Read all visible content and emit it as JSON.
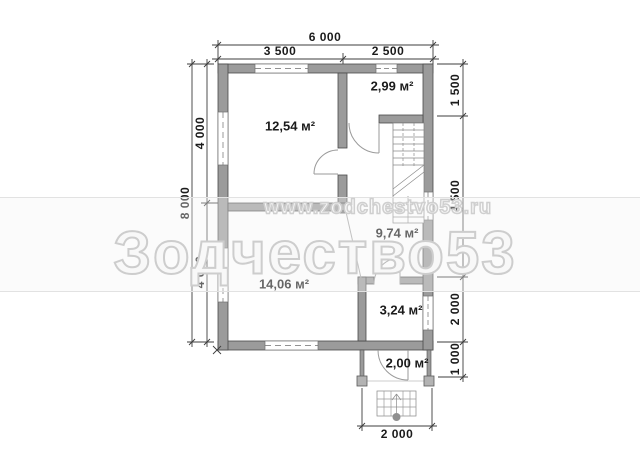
{
  "plan": {
    "rooms": [
      {
        "id": "living-room",
        "area": "12,54 м²"
      },
      {
        "id": "entry-room",
        "area": "2,99 м²"
      },
      {
        "id": "hall-stairs",
        "area": "9,74 м²"
      },
      {
        "id": "main-room",
        "area": "14,06 м²"
      },
      {
        "id": "wc",
        "area": "3,24 м²"
      },
      {
        "id": "porch",
        "area": "2,00 м²"
      }
    ]
  },
  "dimensions": {
    "top": {
      "overall": "6 000",
      "left_span": "3 500",
      "right_span": "2 500"
    },
    "left": {
      "overall": "8 000",
      "upper_span": "4 000",
      "lower_span": "4 000"
    },
    "right": {
      "span1": "1 500",
      "span2": "4 500",
      "span3": "2 000",
      "span4": "1 000"
    },
    "bottom": {
      "porch_span": "2 000"
    }
  },
  "watermark": {
    "url_text": "www.zodchestvo53.ru",
    "brand_text": "Зодчество53"
  },
  "colors": {
    "wall_fill": "#9b9b9b",
    "wall_outline": "#4a4a4a",
    "dimension_line": "#3c3c3c",
    "door_line": "#9a9a9a",
    "watermark_outline": "#cfcfcf"
  }
}
